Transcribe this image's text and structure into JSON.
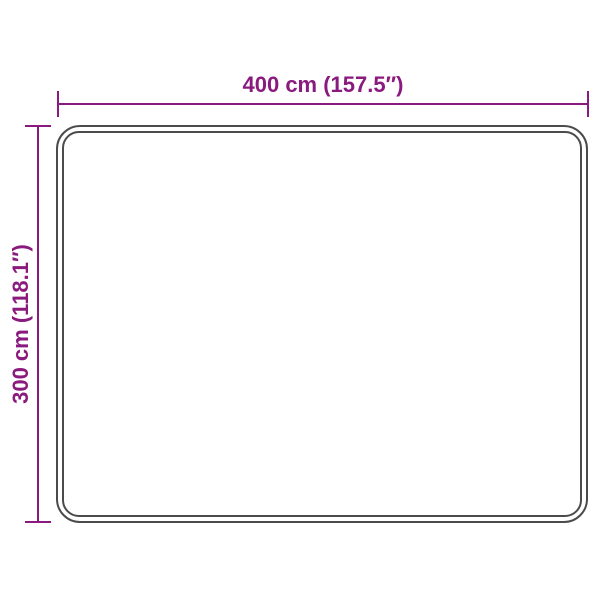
{
  "diagram": {
    "width_label": "400 cm (157.5″)",
    "height_label": "300 cm (118.1″)",
    "accent_color": "#8a1a7e",
    "outline_color": "#4b4b4b",
    "background_color": "#ffffff"
  }
}
